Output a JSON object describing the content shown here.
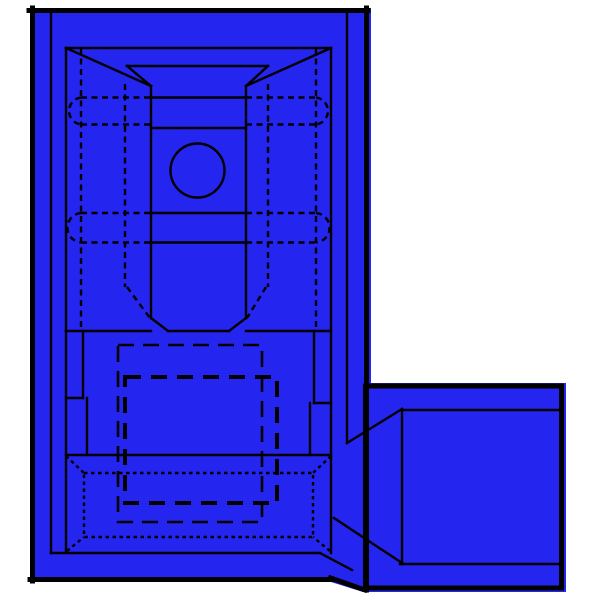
{
  "figure": {
    "title": "Blue insulated flag quick-disconnect terminal - technical line drawing",
    "views": [
      "top view of insulated receptacle body",
      "side wire-barrel square at lower right"
    ],
    "background_color": "#ffffff",
    "colors": {
      "body": "#2525f0",
      "line": "#000000"
    },
    "canvas": {
      "width": 600,
      "height": 600
    },
    "geometry": {
      "fills": [
        "M30,8 L371,8 L371,592 L363,592 L331,582 L30,582 Z",
        "M362,383 L566,383 L566,592 L362,592 Z"
      ],
      "border": [
        "M29,10.5 L368,10.5",
        "M32.5,8 L32.5,581",
        "M366.5,8 L366.5,590",
        "M30,579.5 L333,579.5",
        "M330.5,578 L365,590",
        "M365.5,386 L561.5,386 L561.5,588 L365.5,588 Z"
      ],
      "solid": [
        "M51,13 L51,553",
        "M347,13 L347,443",
        "M66,48 L331,48",
        "M66,48 L66,553",
        "M331,48 L331,553",
        "M51,553 L320,553",
        "M320,553 L352,570",
        "M66,48 L151,86",
        "M331,48 L246,86",
        "M127,66 L268,66",
        "M127,66 L151,86",
        "M268,66 L246,86",
        "M151,86 L151,318",
        "M246,86 L246,318",
        "M151,97.5 L246,97.5",
        "M151,128 L246,128",
        "M151,213 L246,213",
        "M151,242.5 L246,242.5",
        "M151,318 L168,331",
        "M246,318 L229,331",
        "M66,331 L151,331 M168,331 L229,331 M246,331 L331,331",
        "M83,331 L83,398",
        "M66,398 L83,398",
        "M87,398 L87,455",
        "M314,331 L314,403",
        "M314,403 L331,403",
        "M310,403 L310,455",
        "M66,455 L331,455",
        "M347,443 L402,409",
        "M402,409 L402,564",
        "M334,518 L402,563",
        "M402,410 L560,410",
        "M400,564 L560,564"
      ],
      "dashed": [
        "M81,48 L81,330",
        "M316,48 L316,330",
        "M125,84 L125,287",
        "M268,84 L268,287",
        "M127,287 L150,318",
        "M266,287 L247,318",
        "M81,97.5 L151,97.5 M246,97.5 L316,97.5",
        "M81,124.5 L151,124.5 M246,124.5 L316,124.5",
        "M81,213 L151,213 M246,213 L316,213",
        "M81,242.5 L151,242.5 M246,242.5 L316,242.5",
        "M81,97.5 A13.6,13.6 0 0 0 81,124.5",
        "M316,97.5 A13.6,13.6 0 0 1 316,124.5",
        "M81,213 A14.8,14.8 0 0 0 81,242.5",
        "M316,213 A14.8,14.8 0 0 1 316,242.5"
      ],
      "longdash_outer": [
        "M118,345 L262,345 L262,522 L118,522 Z"
      ],
      "longdash_inner": [
        "M125,377 L277,377 L277,503 L125,503 Z"
      ],
      "dotted": [
        "M84,473 L313,473 L313,537 L84,537 Z",
        "M66,456 L84,473",
        "M331,456 L313,473",
        "M67,551 L84,537",
        "M330,551 L313,537"
      ],
      "circle": {
        "cx": 197.5,
        "cy": 170.5,
        "r": 27
      }
    }
  }
}
